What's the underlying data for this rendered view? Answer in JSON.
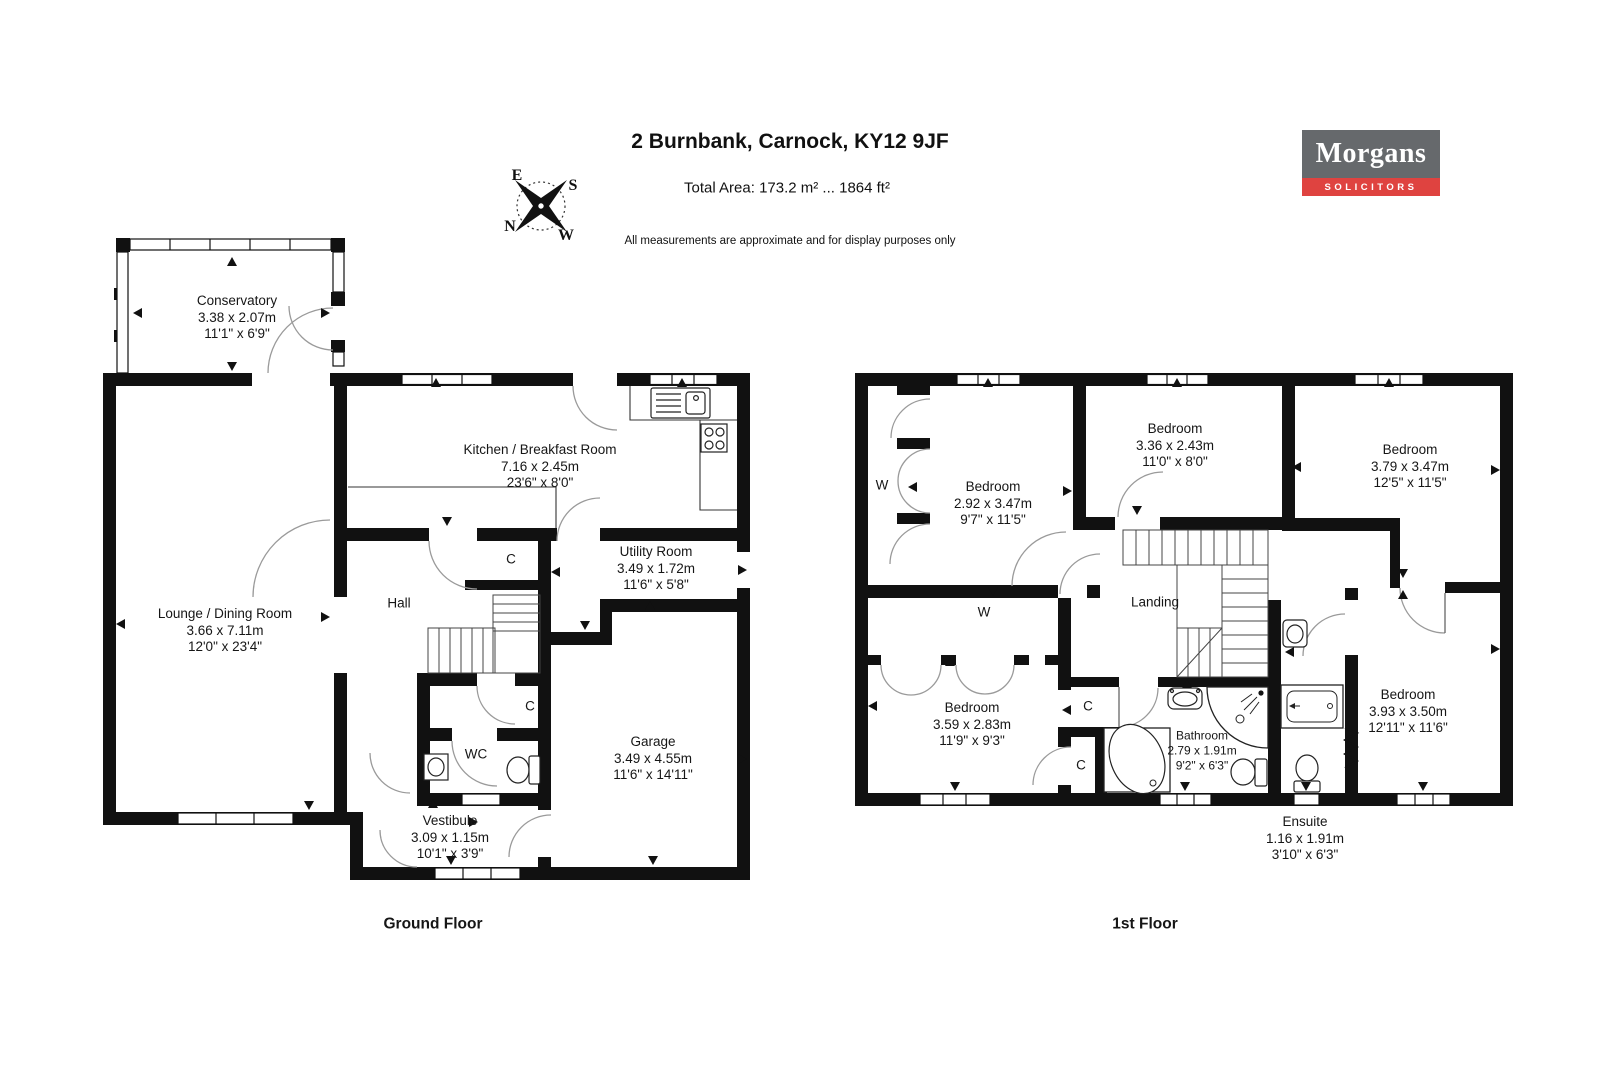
{
  "header": {
    "title": "2 Burnbank, Carnock, KY12 9JF",
    "total_area": "Total Area: 173.2 m² ... 1864 ft²",
    "disclaimer": "All measurements are approximate and for display purposes only"
  },
  "logo": {
    "name": "Morgans",
    "tagline": "SOLICITORS"
  },
  "compass": {
    "n": "N",
    "e": "E",
    "s": "S",
    "w": "W"
  },
  "shared": {
    "cupboard": "C",
    "wardrobe": "W"
  },
  "colors": {
    "logo_gray": "#66696c",
    "logo_red": "#df4340",
    "wall": "#111111",
    "door_arc": "#9a9a9a"
  },
  "ground_floor": {
    "label": "Ground Floor",
    "rooms": {
      "conservatory": {
        "name": "Conservatory",
        "metric": "3.38 x 2.07m",
        "imperial": "11'1\" x 6'9\""
      },
      "lounge": {
        "name": "Lounge / Dining Room",
        "metric": "3.66 x 7.11m",
        "imperial": "12'0\" x 23'4\""
      },
      "kitchen": {
        "name": "Kitchen / Breakfast Room",
        "metric": "7.16 x 2.45m",
        "imperial": "23'6\" x 8'0\""
      },
      "utility": {
        "name": "Utility Room",
        "metric": "3.49 x 1.72m",
        "imperial": "11'6\" x 5'8\""
      },
      "hall": {
        "name": "Hall"
      },
      "wc": {
        "name": "WC"
      },
      "vestibule": {
        "name": "Vestibule",
        "metric": "3.09 x 1.15m",
        "imperial": "10'1\" x 3'9\""
      },
      "garage": {
        "name": "Garage",
        "metric": "3.49 x 4.55m",
        "imperial": "11'6\" x 14'11\""
      }
    }
  },
  "first_floor": {
    "label": "1st Floor",
    "rooms": {
      "bedroom_top_left": {
        "name": "Bedroom",
        "metric": "2.92 x 3.47m",
        "imperial": "9'7\" x 11'5\""
      },
      "bedroom_top_middle": {
        "name": "Bedroom",
        "metric": "3.36 x 2.43m",
        "imperial": "11'0\" x 8'0\""
      },
      "bedroom_top_right": {
        "name": "Bedroom",
        "metric": "3.79 x 3.47m",
        "imperial": "12'5\" x 11'5\""
      },
      "bedroom_bottom_left": {
        "name": "Bedroom",
        "metric": "3.59 x 2.83m",
        "imperial": "11'9\" x 9'3\""
      },
      "bedroom_bottom_right": {
        "name": "Bedroom",
        "metric": "3.93 x 3.50m",
        "imperial": "12'11\" x 11'6\""
      },
      "bathroom": {
        "name": "Bathroom",
        "metric": "2.79 x 1.91m",
        "imperial": "9'2\" x 6'3\""
      },
      "ensuite": {
        "name": "Ensuite",
        "metric": "1.16 x 1.91m",
        "imperial": "3'10\" x 6'3\""
      },
      "landing": {
        "name": "Landing"
      }
    }
  }
}
